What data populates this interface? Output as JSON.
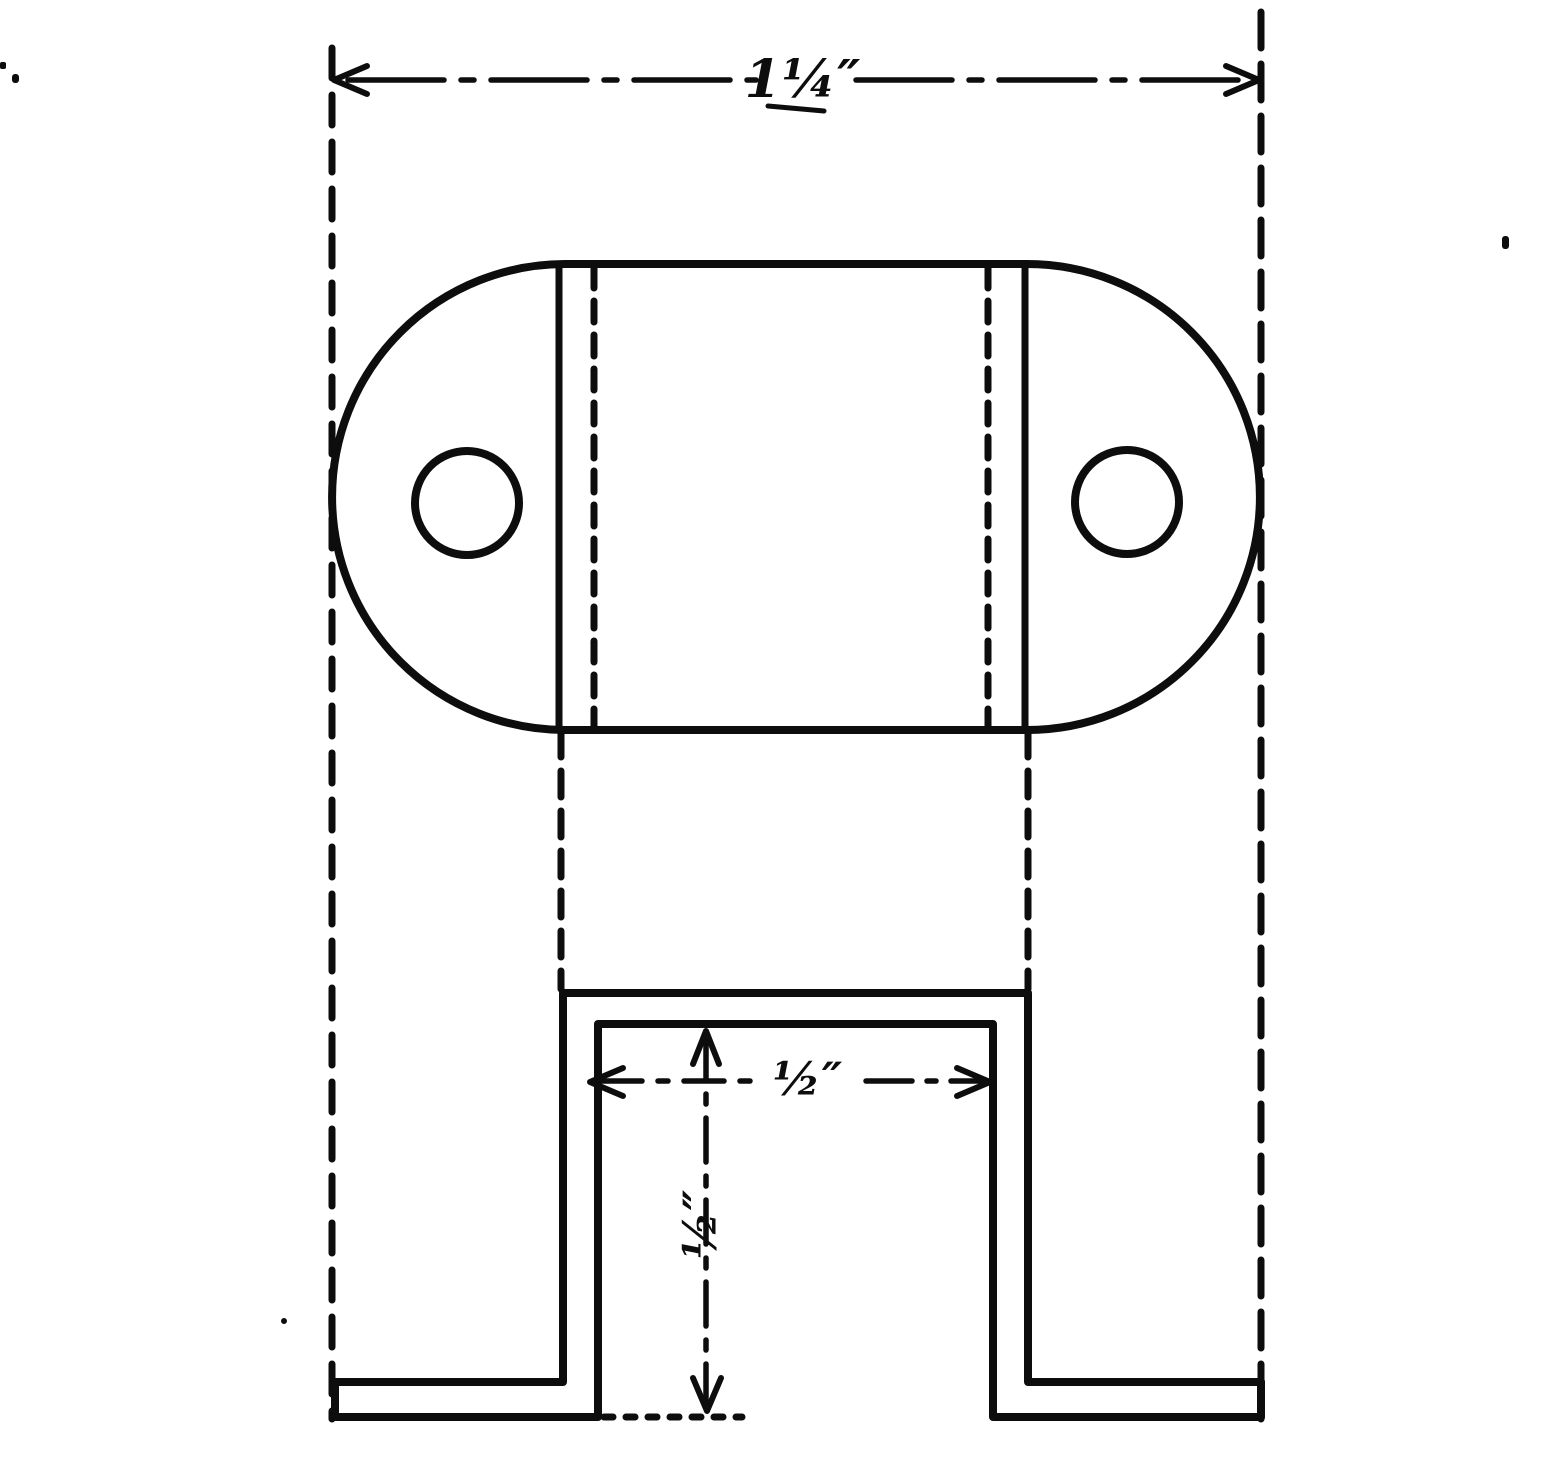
{
  "document": {
    "kind": "hand-drawn two-view engineering sketch",
    "subject": "sheet-metal hat bracket with two round holes",
    "paper_color": "#ffffff",
    "ink_color": "#0d0d0d"
  },
  "dimensions": {
    "overall_width": {
      "label": "1¼″"
    },
    "slot_width": {
      "label": "½″"
    },
    "slot_depth": {
      "label": "½″"
    }
  },
  "views": {
    "top_view": {
      "features": [
        "stadium outline",
        "left hole",
        "right hole",
        "left bend line",
        "right bend line",
        "left hidden edge",
        "right hidden edge"
      ]
    },
    "front_view": {
      "features": [
        "crown",
        "left leg",
        "right leg",
        "left foot",
        "right foot",
        "slot bottom dotted line"
      ]
    }
  }
}
